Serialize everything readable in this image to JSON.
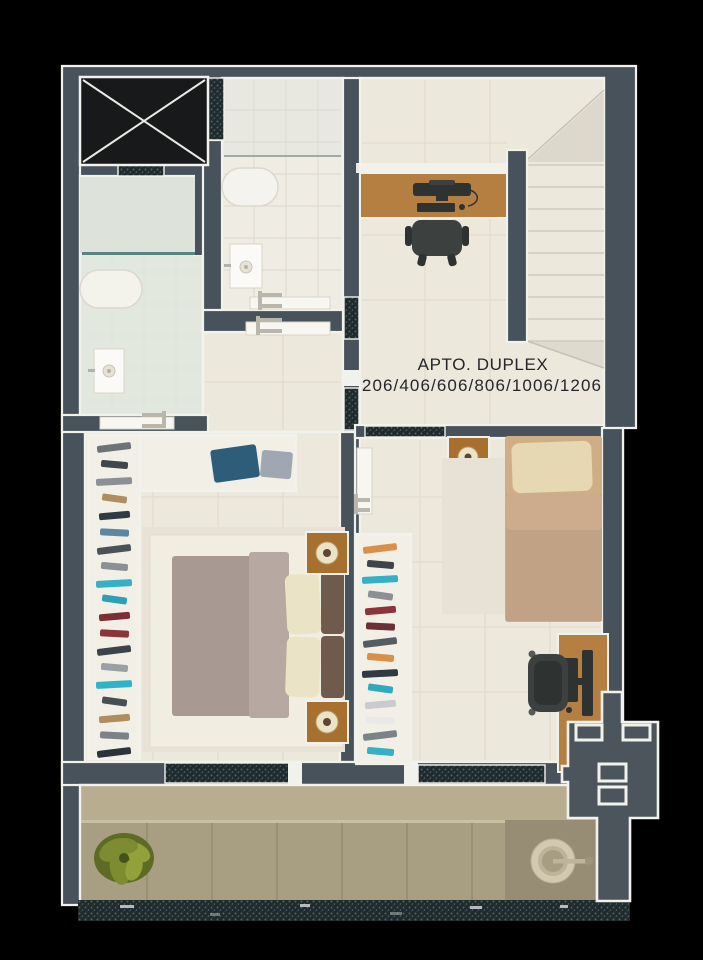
{
  "title": {
    "line1": "APTO. DUPLEX",
    "line2": "206/406/606/806/1006/1206"
  },
  "colors": {
    "bg": "#000000",
    "wall": "#47525A",
    "keyplan": "#4B555B",
    "outline": "#F2F2ED",
    "floor": "#ECE8DC",
    "tile": "#DBD5C6",
    "bathFloor": "#E3E8DF",
    "bathShower": "#DDE3DA",
    "bathTopFloor": "#E8E8E0",
    "bathLowFloor": "#EFECE3",
    "glassTeal": "#3F736D",
    "speckBase": "#20292B",
    "speckTeal": "#2F7472",
    "speckGray": "#5A6668",
    "elevator": "#17191A",
    "elevatorX": "#E9E9E4",
    "doorLeaf": "#F7F6F1",
    "doorHandle": "#B9B6AC",
    "woodDesk": "#B57F42",
    "woodStand": "#A8702F",
    "chair": "#3C403E",
    "chairDark": "#2E3230",
    "duvetMaster": "#A89A92",
    "duvetFold": "#B7A9A1",
    "pillowCream": "#EAE3C6",
    "pillowDark": "#6E5B4E",
    "bedBase": "#F1EDE1",
    "rug": "#E7E2D5",
    "duvetSingle": "#C2A284",
    "duvetRoll": "#CDAC8D",
    "pillowSingle": "#E5D8B2",
    "bedFrame": "#CFAE86",
    "balconyUpper": "#B8AD8F",
    "balconyFloor": "#A89E82",
    "balconyDark": "#978D74",
    "balconyLine": "#948A6F",
    "plantMain": "#7D8B31",
    "plantDark": "#5D6B24",
    "plantLight": "#93A13B",
    "basinOuter": "#D2C9B0",
    "basinMid": "#BDB399",
    "basinInner": "#A79D83",
    "stairTread": "#D6D2C6",
    "landingDiag": "#CFCBBF",
    "textColor": "#26262A",
    "foldedBlue": "#2E5D7A",
    "foldedGray": "#9FA8B0"
  },
  "closets": {
    "master_items": [
      "#6d7276",
      "#3f464c",
      "#8a9094",
      "#b08d5e",
      "#2f3a44",
      "#5d87a0",
      "#4a5258",
      "#8a9094",
      "#35b0c6",
      "#2f9fb8",
      "#7c2f35",
      "#8c343c",
      "#3c444a",
      "#9aa0a4",
      "#2fb3c9",
      "#474f55",
      "#b08d5e",
      "#7b8288",
      "#2b333b"
    ],
    "second_items": [
      "#d98f4a",
      "#3d454b",
      "#35b0c6",
      "#8a9094",
      "#8c343c",
      "#6d2f35",
      "#555c62",
      "#d98f4a",
      "#2f3a42",
      "#2fa9c0",
      "#c9ccce",
      "#e9eae8",
      "#7b8288",
      "#35b0c6"
    ]
  }
}
